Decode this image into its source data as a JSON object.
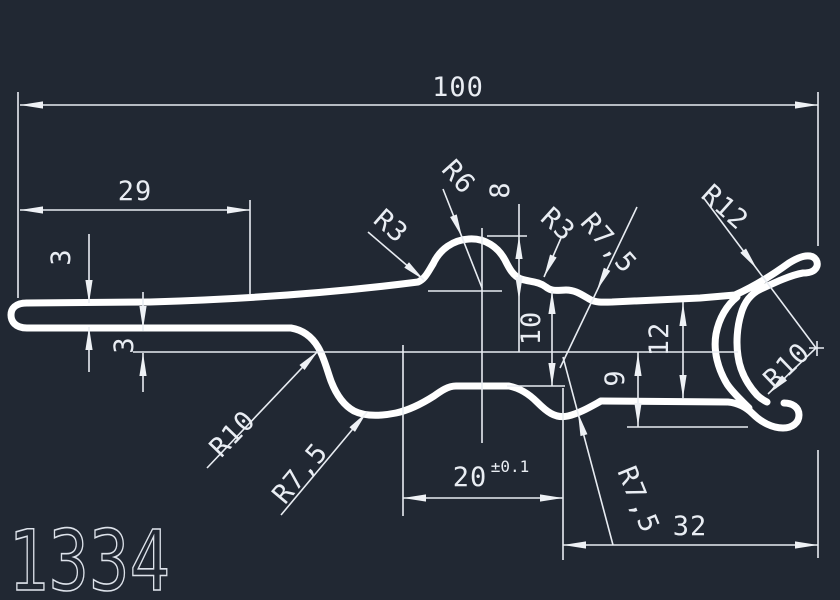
{
  "app": {
    "type": "cad-drawing-view",
    "background": "#212833",
    "profile_color": "#ffffff",
    "dimension_color": "#e9edf3"
  },
  "drawing_number": "1334",
  "dims": {
    "width100": {
      "label": "100"
    },
    "width29": {
      "label": "29"
    },
    "thk3a": {
      "label": "3"
    },
    "thk3b": {
      "label": "3"
    },
    "height8": {
      "label": "8"
    },
    "height10": {
      "label": "10"
    },
    "height12": {
      "label": "12"
    },
    "height9": {
      "label": "9"
    },
    "width20": {
      "label": "20",
      "tolerance": "±0.1"
    },
    "width32": {
      "label": "32"
    }
  },
  "radii": {
    "r3_left": {
      "label": "R3"
    },
    "r6_top": {
      "label": "R6"
    },
    "r3_right": {
      "label": "R3"
    },
    "r75_top": {
      "label": "R7,5"
    },
    "r12_hook": {
      "label": "R12"
    },
    "r10_hook": {
      "label": "R10"
    },
    "r10_left": {
      "label": "R10"
    },
    "r75_left": {
      "label": "R7,5"
    },
    "r75_bottom": {
      "label": "R7,5"
    }
  }
}
